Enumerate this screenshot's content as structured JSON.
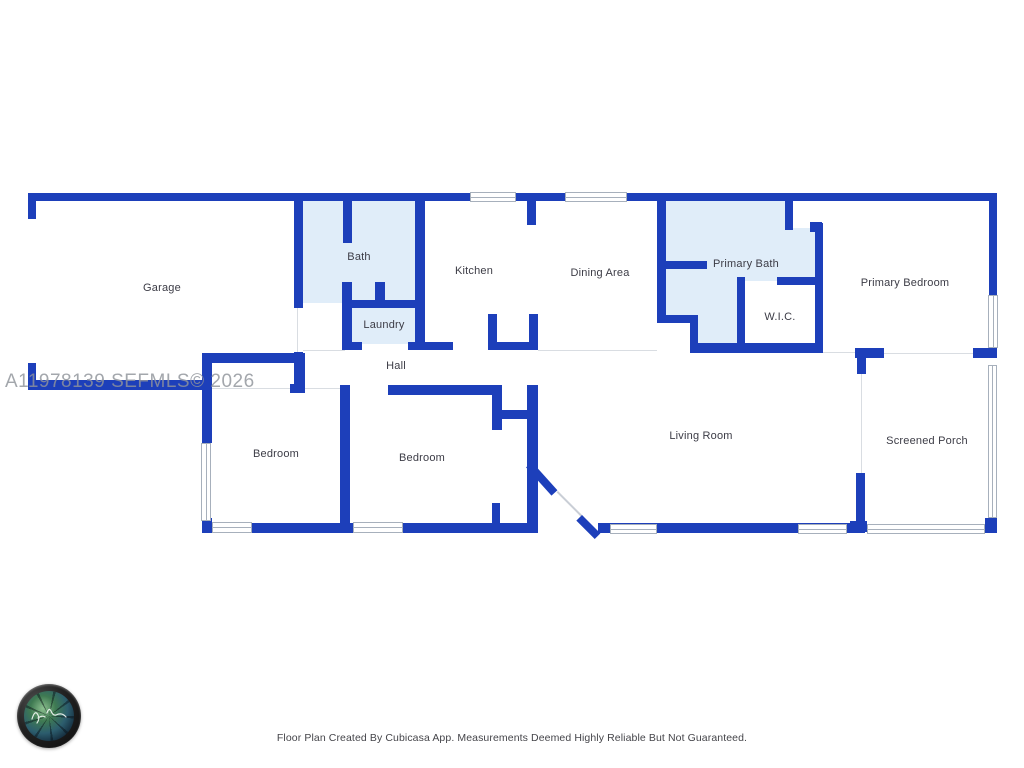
{
  "floor_plan": {
    "rooms": [
      {
        "id": "garage",
        "label": "Garage"
      },
      {
        "id": "bath",
        "label": "Bath"
      },
      {
        "id": "kitchen",
        "label": "Kitchen"
      },
      {
        "id": "laundry",
        "label": "Laundry"
      },
      {
        "id": "hall",
        "label": "Hall"
      },
      {
        "id": "dining-area",
        "label": "Dining Area"
      },
      {
        "id": "primary-bath",
        "label": "Primary Bath"
      },
      {
        "id": "wic",
        "label": "W.I.C."
      },
      {
        "id": "primary-bedroom",
        "label": "Primary Bedroom"
      },
      {
        "id": "bedroom-left",
        "label": "Bedroom"
      },
      {
        "id": "bedroom-middle",
        "label": "Bedroom"
      },
      {
        "id": "living-room",
        "label": "Living Room"
      },
      {
        "id": "screened-porch",
        "label": "Screened Porch"
      }
    ]
  },
  "watermark": {
    "text": "A11978139 SEFMLS© 2026"
  },
  "footer": {
    "text": "Floor Plan Created By Cubicasa App. Measurements Deemed Highly Reliable But Not Guaranteed."
  },
  "branding": {
    "logo": "camera-lens-logo"
  },
  "palette": {
    "wall_blue": "#1d3fba",
    "room_fill_blue": "#e0edf9",
    "boundary_line": "#d9dde2",
    "label_text": "#3c3c46",
    "watermark_gray": "#90949b"
  }
}
